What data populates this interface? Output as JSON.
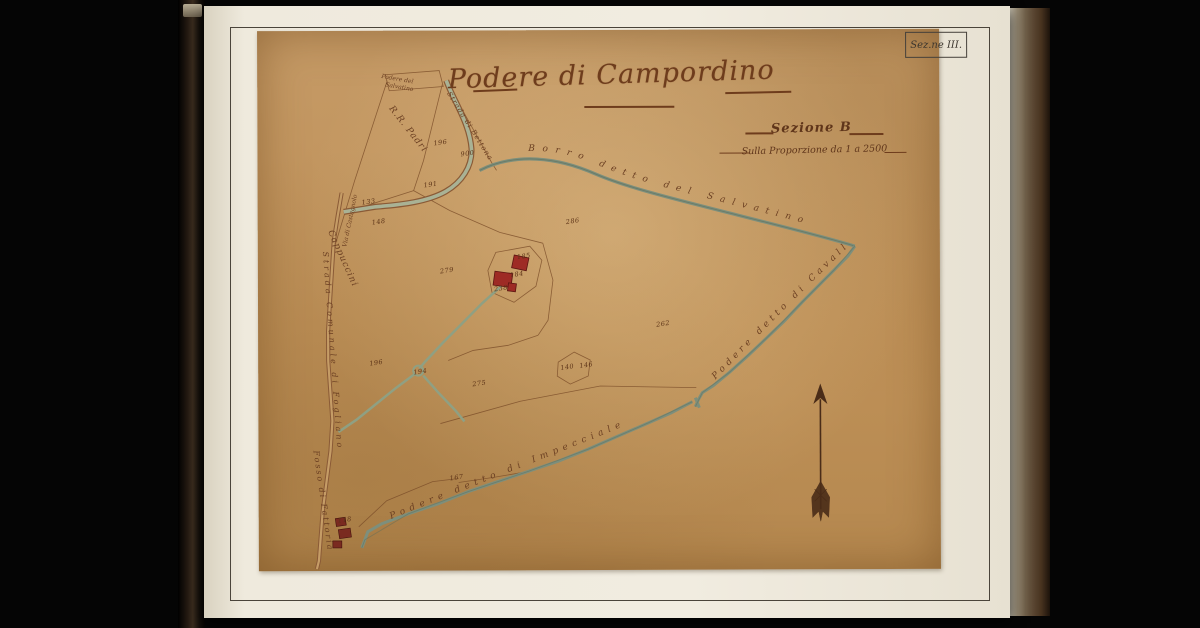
{
  "scan": {
    "corner_label": "Sez.ne III.",
    "title": "Podere di Campordino",
    "section_label": "Sezione B",
    "scale_label": "Sulla Proporzione da 1 a 2500"
  },
  "map": {
    "labels": [
      {
        "text": "Podere del",
        "x": 140,
        "y": 49,
        "rot": 10,
        "size": 6,
        "sp": 0
      },
      {
        "text": "Salvatino",
        "x": 142,
        "y": 57,
        "rot": 10,
        "size": 6,
        "sp": 0
      },
      {
        "text": "R.R. Padri",
        "x": 150,
        "y": 99,
        "rot": 52,
        "size": 9,
        "sp": 1
      },
      {
        "text": "Cappuccini",
        "x": 84,
        "y": 228,
        "rot": 66,
        "size": 9,
        "sp": 1
      },
      {
        "text": "Strada di Bettona",
        "x": 212,
        "y": 96,
        "rot": 58,
        "size": 7,
        "sp": 1
      },
      {
        "text": "Via di Castagnolo",
        "x": 93,
        "y": 190,
        "rot": -78,
        "size": 6,
        "sp": 0
      },
      {
        "text": "Strada Comunale di Fogliano",
        "x": 74,
        "y": 320,
        "rot": 86,
        "size": 8,
        "sp": 3
      },
      {
        "text": "Fosso di Fattoria",
        "x": 64,
        "y": 470,
        "rot": 82,
        "size": 8,
        "sp": 2
      }
    ],
    "path_labels": [
      {
        "path": "lp-stream",
        "text": "Borro detto del Salvatino",
        "size": 9,
        "sp": 7,
        "offset": "12%",
        "dy": -4
      },
      {
        "path": "lp-cavalligio",
        "text": "Podere detto di Cavalligio",
        "size": 9,
        "sp": 4,
        "offset": "10%",
        "dy": -5
      },
      {
        "path": "lp-impecciale",
        "text": "Podere detto di Impecciale",
        "size": 9,
        "sp": 5,
        "offset": "10%",
        "dy": -6
      }
    ],
    "parcel_numbers": [
      {
        "n": "196",
        "x": 183,
        "y": 112
      },
      {
        "n": "900",
        "x": 210,
        "y": 123
      },
      {
        "n": "191",
        "x": 173,
        "y": 154
      },
      {
        "n": "133",
        "x": 111,
        "y": 171
      },
      {
        "n": "148",
        "x": 121,
        "y": 191
      },
      {
        "n": "286",
        "x": 315,
        "y": 191
      },
      {
        "n": "185",
        "x": 266,
        "y": 226
      },
      {
        "n": "184",
        "x": 259,
        "y": 244
      },
      {
        "n": "238",
        "x": 243,
        "y": 258
      },
      {
        "n": "279",
        "x": 189,
        "y": 240
      },
      {
        "n": "196",
        "x": 118,
        "y": 332
      },
      {
        "n": "194",
        "x": 162,
        "y": 341
      },
      {
        "n": "275",
        "x": 221,
        "y": 353
      },
      {
        "n": "262",
        "x": 405,
        "y": 294
      },
      {
        "n": "140",
        "x": 309,
        "y": 337
      },
      {
        "n": "146",
        "x": 328,
        "y": 335
      },
      {
        "n": "167",
        "x": 198,
        "y": 447
      },
      {
        "n": "118",
        "x": 86,
        "y": 489
      }
    ],
    "icons": {
      "compass": "north-arrow"
    }
  },
  "colors": {
    "background": "#050505",
    "page": "#f1ece0",
    "sheet": "#bf9158",
    "ink": "#6b3f22",
    "water_green": "#7d8f7c",
    "buildings_red": "#9e2b25"
  }
}
